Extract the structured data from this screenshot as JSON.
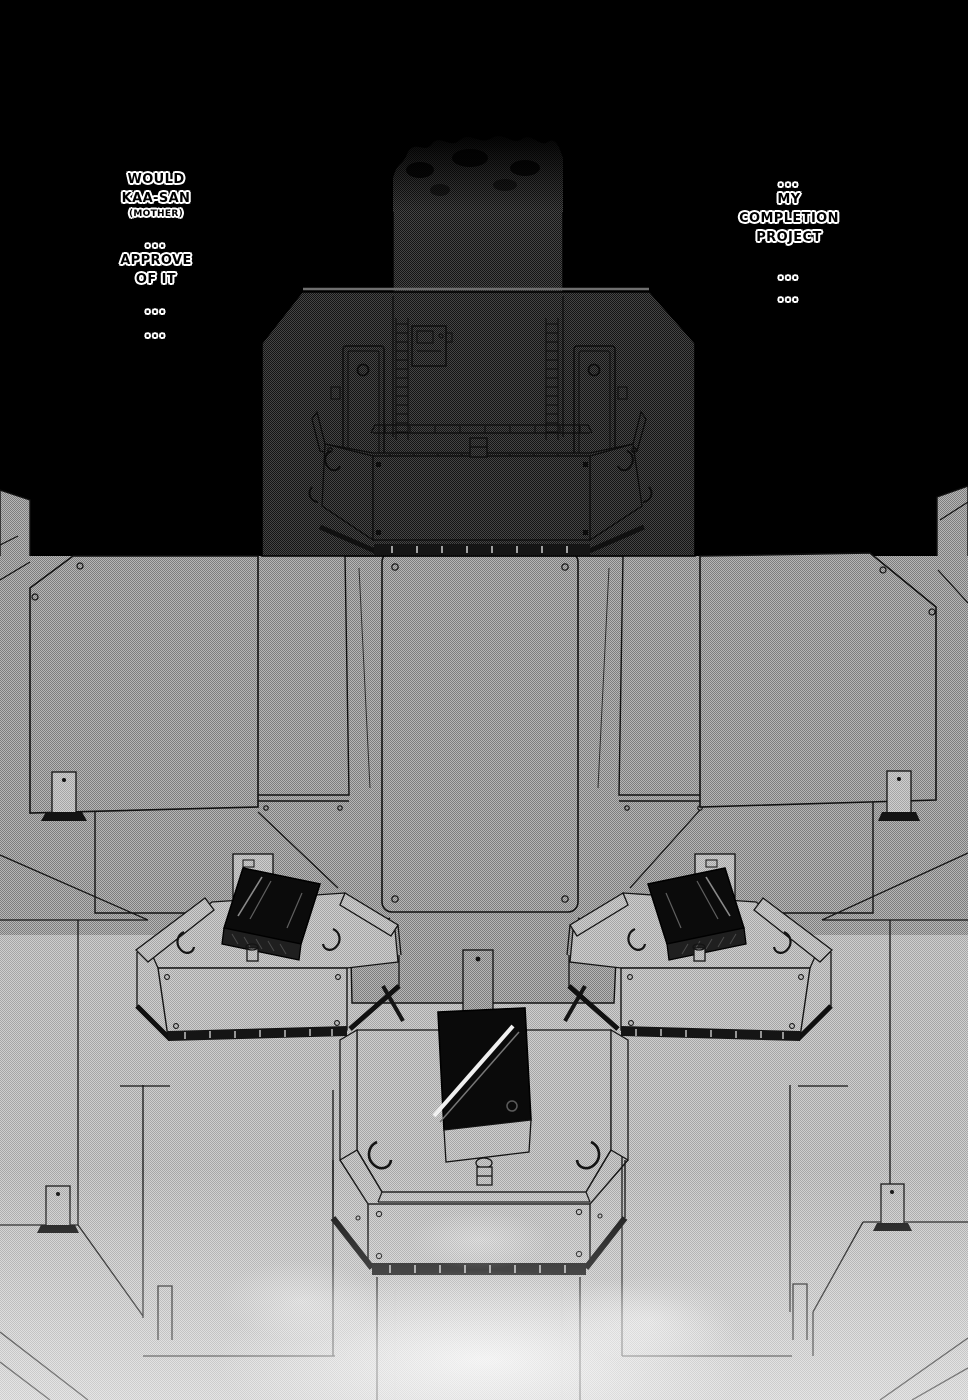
{
  "balloons": {
    "left": {
      "group1": [
        "WOULD",
        "KAA-SAN",
        "(MOTHER)"
      ],
      "dots1": "...",
      "group2": [
        "APPROVE",
        "OF IT"
      ],
      "dots2": "...",
      "dots3": "..."
    },
    "right": {
      "dots1": "...",
      "group1": [
        "MY",
        "COMPLETION",
        "PROJECT"
      ],
      "dots2": "...",
      "dots3": "..."
    }
  },
  "colors": {
    "background": "#000000",
    "line_art": "#111111",
    "tone_dark": "#2f2f2f",
    "tone_mid": "#9a9a9a",
    "tone_light": "#bcbcbc",
    "console_black": "#0b0b0b",
    "highlight": "#f0f0f0",
    "text_fill": "#000000",
    "text_outline": "#ffffff"
  }
}
